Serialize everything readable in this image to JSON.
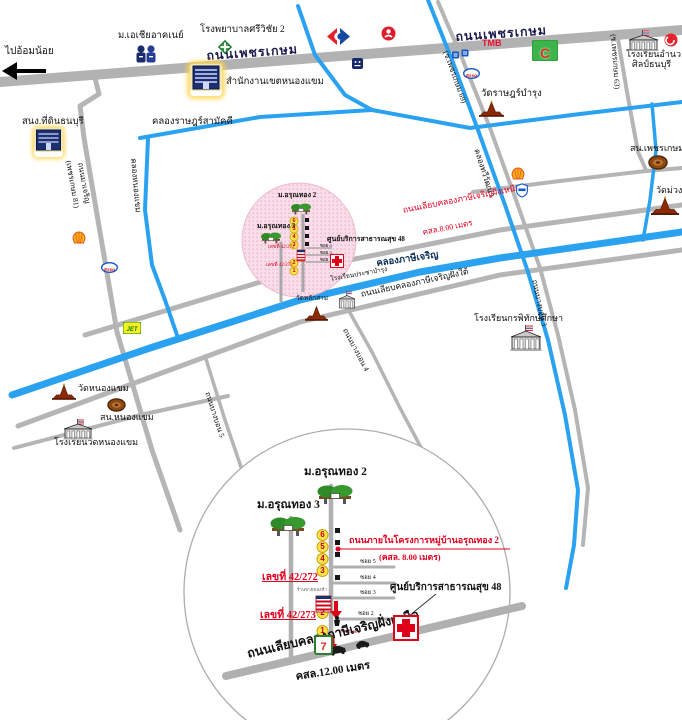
{
  "map": {
    "west": "ไปอ้อมน้อย",
    "roads": {
      "phetkasem_a": "ถนนเพชรเกษม",
      "phetkasem_b": "ถนนเพชรเกษม",
      "phetkasem81": "(เพชรเกษม 81)",
      "macharoen": "ถนนมาเจริญ",
      "soi63": "(ซ.เพชรเกษม 63)",
      "soi69": "(ซ.เพชรเกษม 69)",
      "bangbon3": "ถนนบางบอน 3",
      "bangbon4": "ถนนบางบอน 4",
      "bangbon5": "ถนนบางบอน 5",
      "liab_nuea": "ถนนเลียบคลองภาษีเจริญฝั่งเหนือ",
      "liab_nuea_spec": "คสล.8.00 เมตร",
      "liab_tai": "ถนนเลียบคลองภาษีเจริญฝั่งใต้"
    },
    "canals": {
      "rat_samakkhi": "คลองราษฎร์สามัคคี",
      "nong_khaem": "คลองหนองแขม",
      "thawi_watthana": "คลองทวีวัฒนา",
      "phasi_charoen": "คลองภาษีเจริญ"
    },
    "places": {
      "asia_univ": "ม.เอเชียอาคเนย์",
      "hospital": "โรงพยาบาลศรีวิชัย 2",
      "district_office": "สำนักงานเขตหนองแขม",
      "land_office": "สนง.ที่ดินธนบุรี",
      "amnuaysilp1": "โรงเรียนอำนวย",
      "amnuaysilp2": "ศิลป์ธนบุรี",
      "wat_rat_bamrung": "วัดราษฎร์บำรุง",
      "police_phetkasem": "สน.เพชรเกษม",
      "wat_muang": "วัดม่วง",
      "kornpitak": "โรงเรียนกรพิทักษ์ศึกษา",
      "wat_nong_khaem": "วัดหนองแขม",
      "police_nong_khaem": "สน.หนองแขม",
      "school_wat_nong_khaem": "โรงเรียนวัดหนองแขม",
      "wat_lak_sam": "วัดหลักสาม",
      "prachabamrung": "โรงเรียนประชาบำรุง"
    },
    "brands": {
      "tmb": "TMB",
      "bigc": "C",
      "esso": "Esso",
      "jet": "JET"
    }
  },
  "highlight": {
    "arunthong2": "ม.อรุณทอง 2",
    "arunthong3": "ม.อรุณทอง 3",
    "health48": "ศูนย์บริการสาธารณสุข 48",
    "addr272": "เลขที่ 42/272",
    "addr273": "เลขที่ 42/273",
    "stops": [
      "6",
      "5",
      "4",
      "3",
      "2",
      "1"
    ],
    "sois": [
      "ซอย 4",
      "ซอย 3",
      "ซอย 2"
    ]
  },
  "inset": {
    "arunthong2": "ม.อรุณทอง 2",
    "arunthong3": "ม.อรุณทอง 3",
    "internal_road": "ถนนภายในโครงการหมู่บ้านอรุณทอง 2",
    "internal_spec": "(คสล. 8.00 เมตร)",
    "addr272": "เลขที่ 42/272",
    "addr273": "เลขที่ 42/273",
    "health48": "ศูนย์บริการสาธารณสุข 48",
    "bottom_road": "ถนนเลียบคลองภาษีเจริญฝั่งเหนือ",
    "bottom_spec": "คสล.12.00 เมตร",
    "width_note": "3.00 เมตร",
    "shop_note": "ร้านขายของชำ",
    "seven": "7",
    "stops": [
      "6",
      "5",
      "4",
      "3",
      "2",
      "1"
    ],
    "sois": [
      "ซอย 5",
      "ซอย 4",
      "ซอย 3",
      "ซอย 2"
    ]
  }
}
